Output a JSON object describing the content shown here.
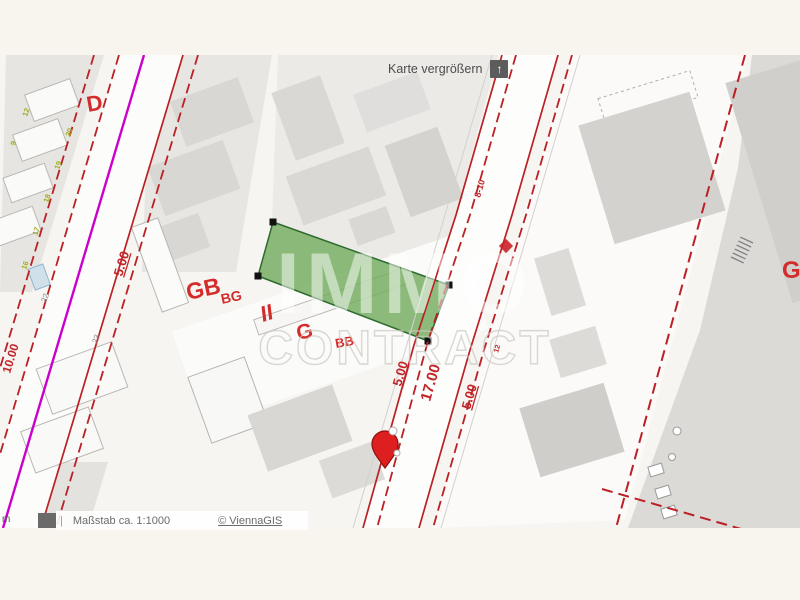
{
  "controls": {
    "enlarge_label": "Karte vergrößern",
    "enlarge_icon": "arrow-up",
    "enlarge_glyph": "↑"
  },
  "footer": {
    "unit": "m",
    "divider": "|",
    "scale": "Maßstab ca. 1:1000",
    "attribution": "© ViennaGIS"
  },
  "watermark": {
    "line1": "IMMO",
    "line2": "CONTRACT"
  },
  "zoning_labels": {
    "d": "D",
    "gb": "GB",
    "gb_sub": "BG",
    "ii": "II",
    "g": "G",
    "bb": "BB",
    "g_right": "G"
  },
  "dimension_labels": {
    "street_left": "5.00",
    "street_width": "17.00",
    "street_right": "5.00",
    "west_street": "5.00",
    "west_depth": "10.00",
    "house_range": "8-10",
    "small_note": "12"
  },
  "house_numbers": {
    "olive": [
      "12",
      "9",
      "20",
      "19",
      "18",
      "17",
      "16"
    ],
    "gray": [
      "22",
      "23"
    ]
  },
  "colors": {
    "parcel_fill": "#6faa5a",
    "parcel_stroke": "#2e6b2e",
    "boundary_red": "#bb2025",
    "label_red": "#d42b2b",
    "magenta_line": "#cc00cc",
    "marker_red": "#dd1f1f",
    "watermark_white": "#ffffff",
    "background_cream": "#f8f5ef"
  }
}
